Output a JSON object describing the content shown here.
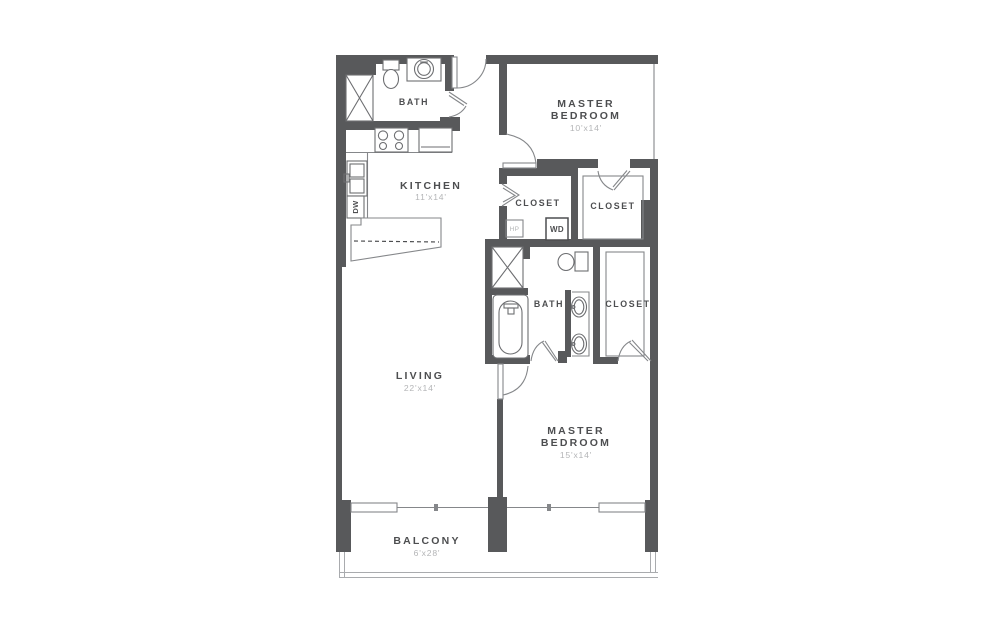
{
  "floorplan": {
    "rooms": {
      "bath_top": {
        "label": "BATH"
      },
      "master_bedroom_1": {
        "line1": "MASTER",
        "line2": "BEDROOM",
        "dims": "10'x14'"
      },
      "kitchen": {
        "label": "KITCHEN",
        "dims": "11'x14'"
      },
      "closet_hall": {
        "label": "CLOSET"
      },
      "closet_mb1": {
        "label": "CLOSET"
      },
      "bath_main": {
        "label": "BATH"
      },
      "closet_mb2": {
        "label": "CLOSET"
      },
      "living": {
        "label": "LIVING",
        "dims": "22'x14'"
      },
      "master_bedroom_2": {
        "line1": "MASTER",
        "line2": "BEDROOM",
        "dims": "15'x14'"
      },
      "balcony": {
        "label": "BALCONY",
        "dims": "6'x28'"
      }
    },
    "appliances": {
      "dishwasher": "DW",
      "washer_dryer": "WD",
      "heat_pump": "HP"
    },
    "colors": {
      "wall": "#58595b",
      "line": "#85878a",
      "fixture": "#6d6e71",
      "label": "#4d4e50",
      "dim": "#b4b5b7",
      "background": "#ffffff"
    }
  }
}
